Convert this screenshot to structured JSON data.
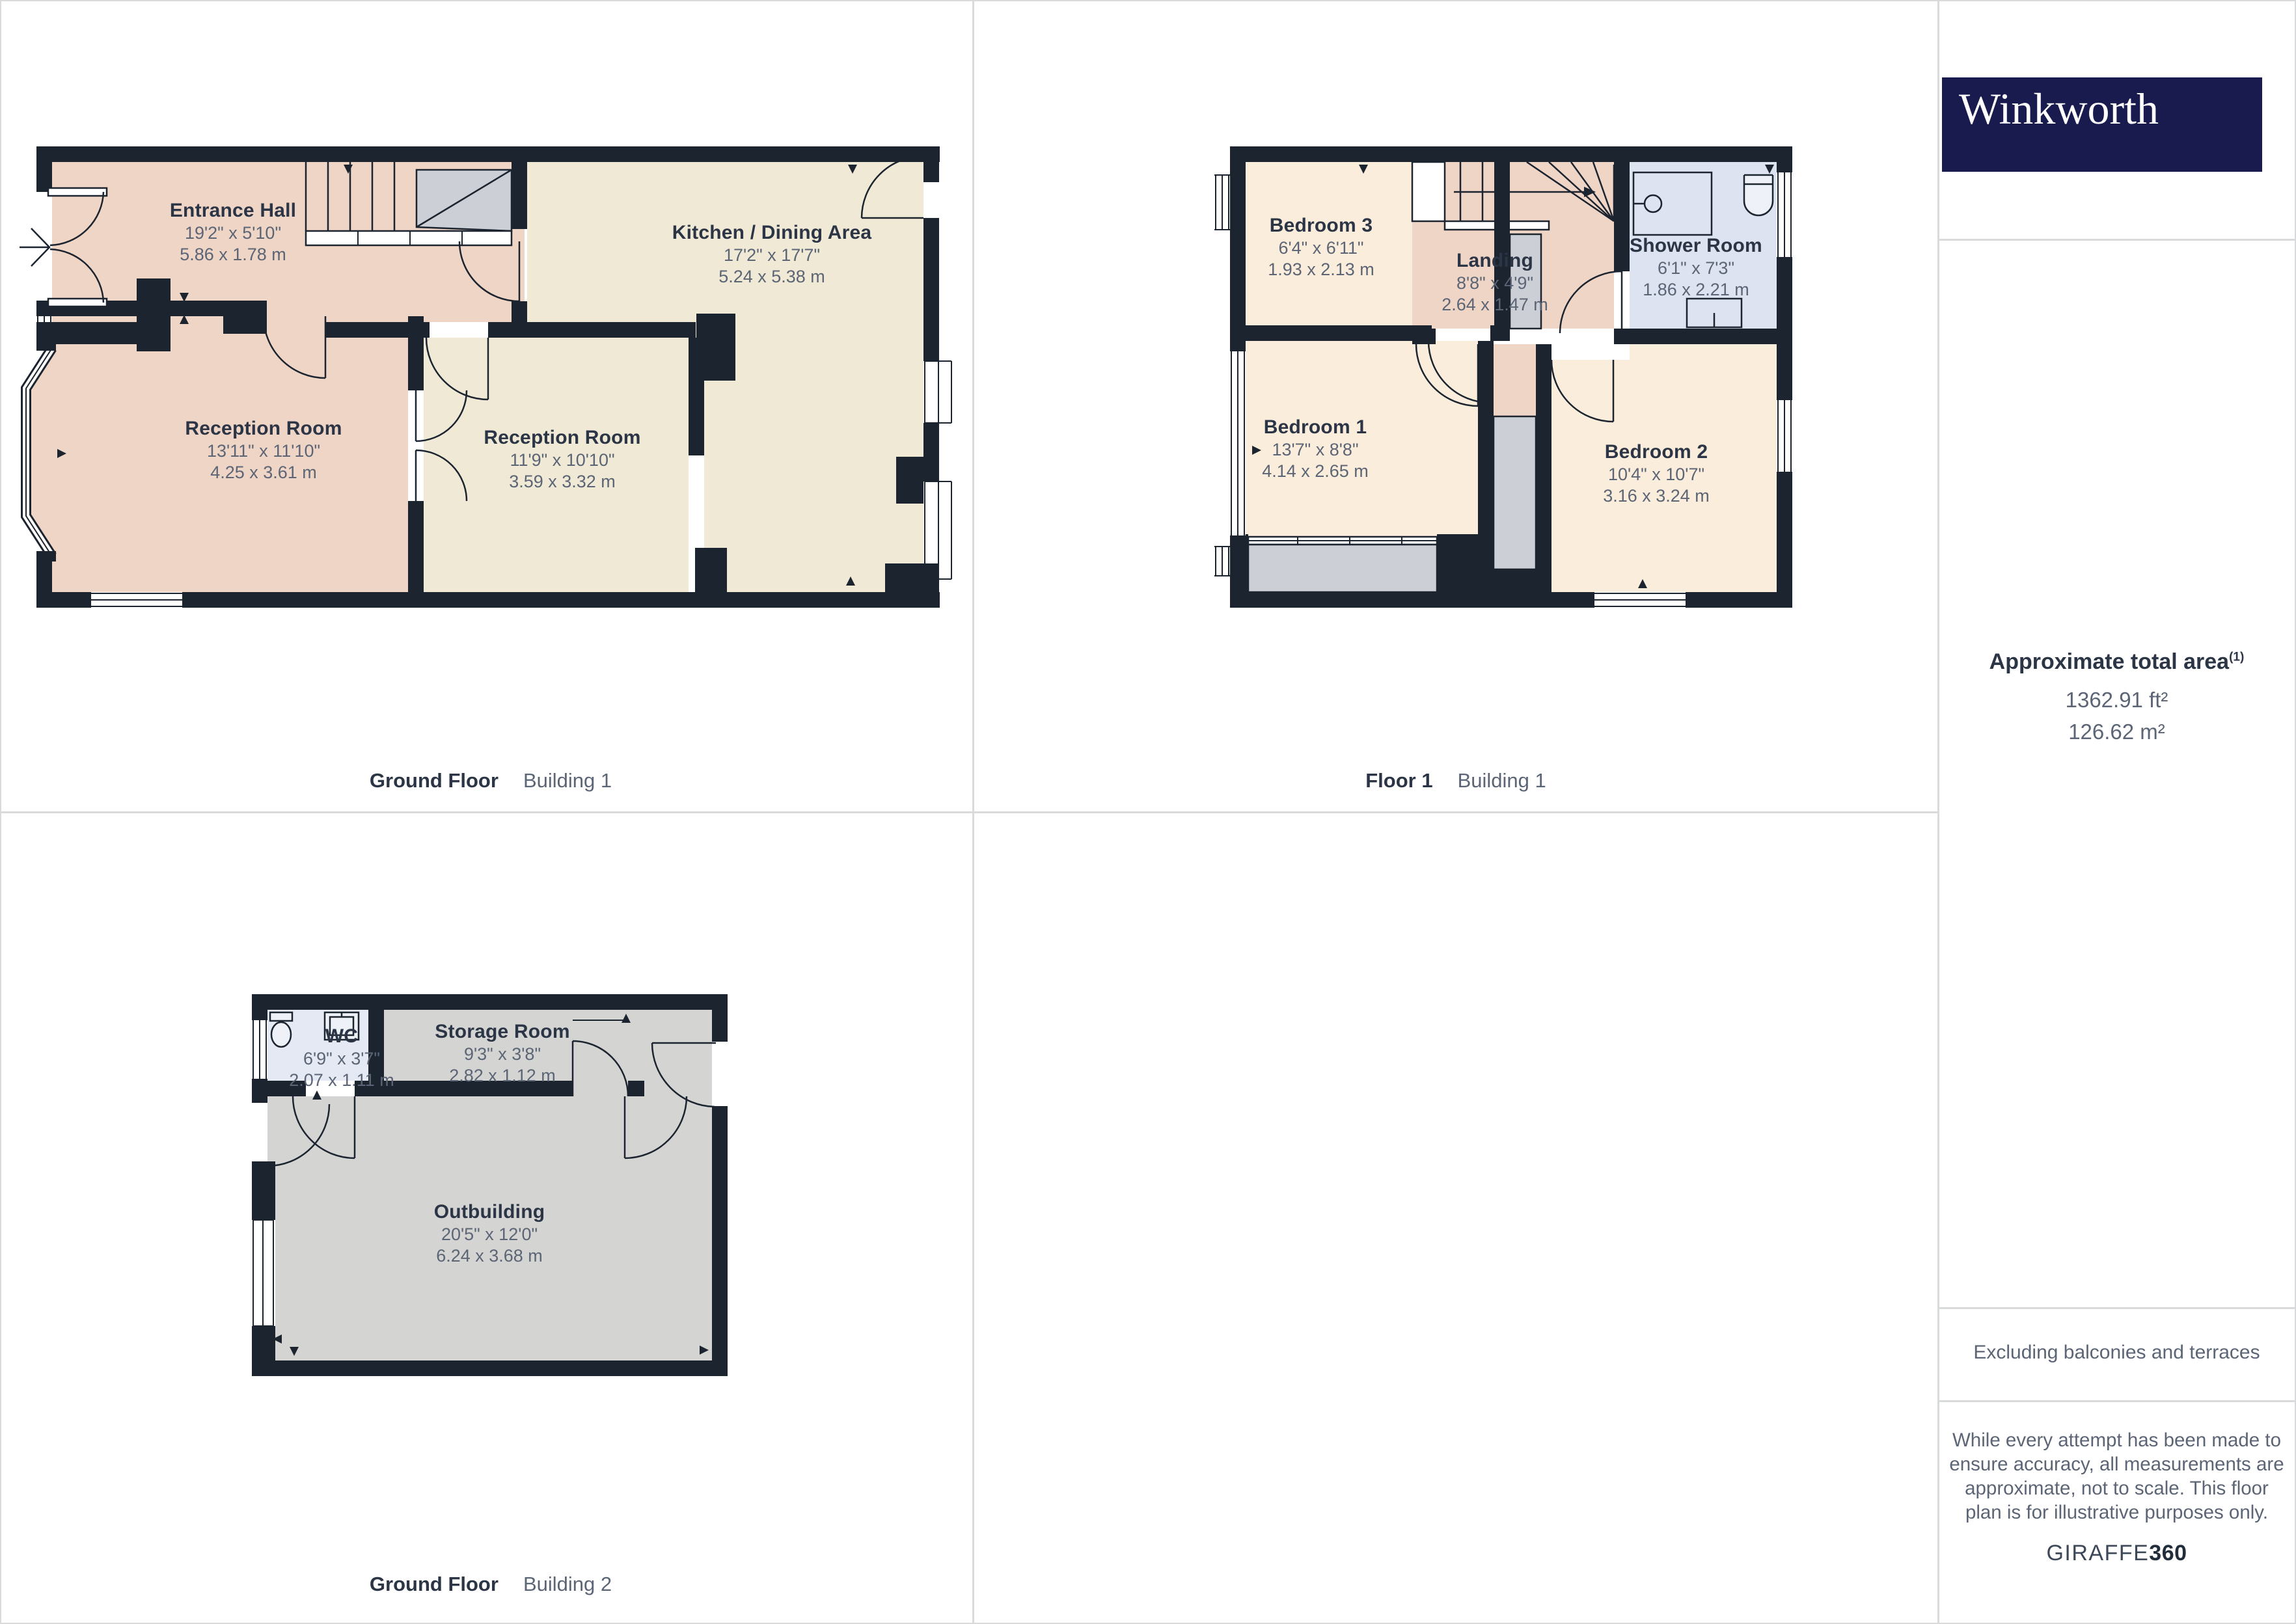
{
  "brand": {
    "logo_text": "Winkworth"
  },
  "sidebar": {
    "total_area_label": "Approximate total area",
    "total_area_sup": "(1)",
    "area_ft": "1362.91 ft²",
    "area_m": "126.62 m²",
    "excluding_note": "Excluding balconies and terraces",
    "disclaimer_lines": [
      "While every attempt has been made to",
      "ensure accuracy, all measurements are",
      "approximate, not to scale. This floor",
      "plan is for illustrative purposes only."
    ],
    "giraffe_brand": "GIRAFFE",
    "giraffe_360": "360"
  },
  "plans": [
    {
      "floor_label": "Ground Floor",
      "building_label": "Building 1",
      "rooms": [
        {
          "name": "Entrance Hall",
          "dims_ft": "19'2\" x 5'10\"",
          "dims_m": "5.86 x 1.78 m"
        },
        {
          "name": "Reception Room",
          "dims_ft": "13'11\" x 11'10\"",
          "dims_m": "4.25 x 3.61 m"
        },
        {
          "name": "Reception Room",
          "dims_ft": "11'9\" x 10'10\"",
          "dims_m": "3.59 x 3.32 m"
        },
        {
          "name": "Kitchen / Dining Area",
          "dims_ft": "17'2\" x 17'7\"",
          "dims_m": "5.24 x 5.38 m"
        }
      ]
    },
    {
      "floor_label": "Floor 1",
      "building_label": "Building 1",
      "rooms": [
        {
          "name": "Bedroom 3",
          "dims_ft": "6'4\" x 6'11\"",
          "dims_m": "1.93 x 2.13 m"
        },
        {
          "name": "Landing",
          "dims_ft": "8'8\" x 4'9\"",
          "dims_m": "2.64 x 1.47 m"
        },
        {
          "name": "Shower Room",
          "dims_ft": "6'1\" x 7'3\"",
          "dims_m": "1.86 x 2.21 m"
        },
        {
          "name": "Bedroom 1",
          "dims_ft": "13'7\" x 8'8\"",
          "dims_m": "4.14 x 2.65 m"
        },
        {
          "name": "Bedroom 2",
          "dims_ft": "10'4\" x 10'7\"",
          "dims_m": "3.16 x 3.24 m"
        }
      ]
    },
    {
      "floor_label": "Ground Floor",
      "building_label": "Building 2",
      "rooms": [
        {
          "name": "WC",
          "dims_ft": "6'9\" x 3'7\"",
          "dims_m": "2.07 x 1.11 m"
        },
        {
          "name": "Storage Room",
          "dims_ft": "9'3\" x 3'8\"",
          "dims_m": "2.82 x 1.12 m"
        },
        {
          "name": "Outbuilding",
          "dims_ft": "20'5\" x 12'0\"",
          "dims_m": "6.24 x 3.68 m"
        }
      ]
    }
  ],
  "colors": {
    "wall": "#1c2430",
    "pink": "#efd5c6",
    "cream": "#f0e9d6",
    "peach": "#fbeddc",
    "blue": "#dde3f0",
    "wc_blue": "#e4e9f3",
    "room_gray": "#d4d5d3",
    "stair_gray": "#ccd0d6",
    "ink": "#2b3545",
    "dim": "#5c6575",
    "divider": "#d9dadc",
    "logo_navy": "#191a4e"
  }
}
